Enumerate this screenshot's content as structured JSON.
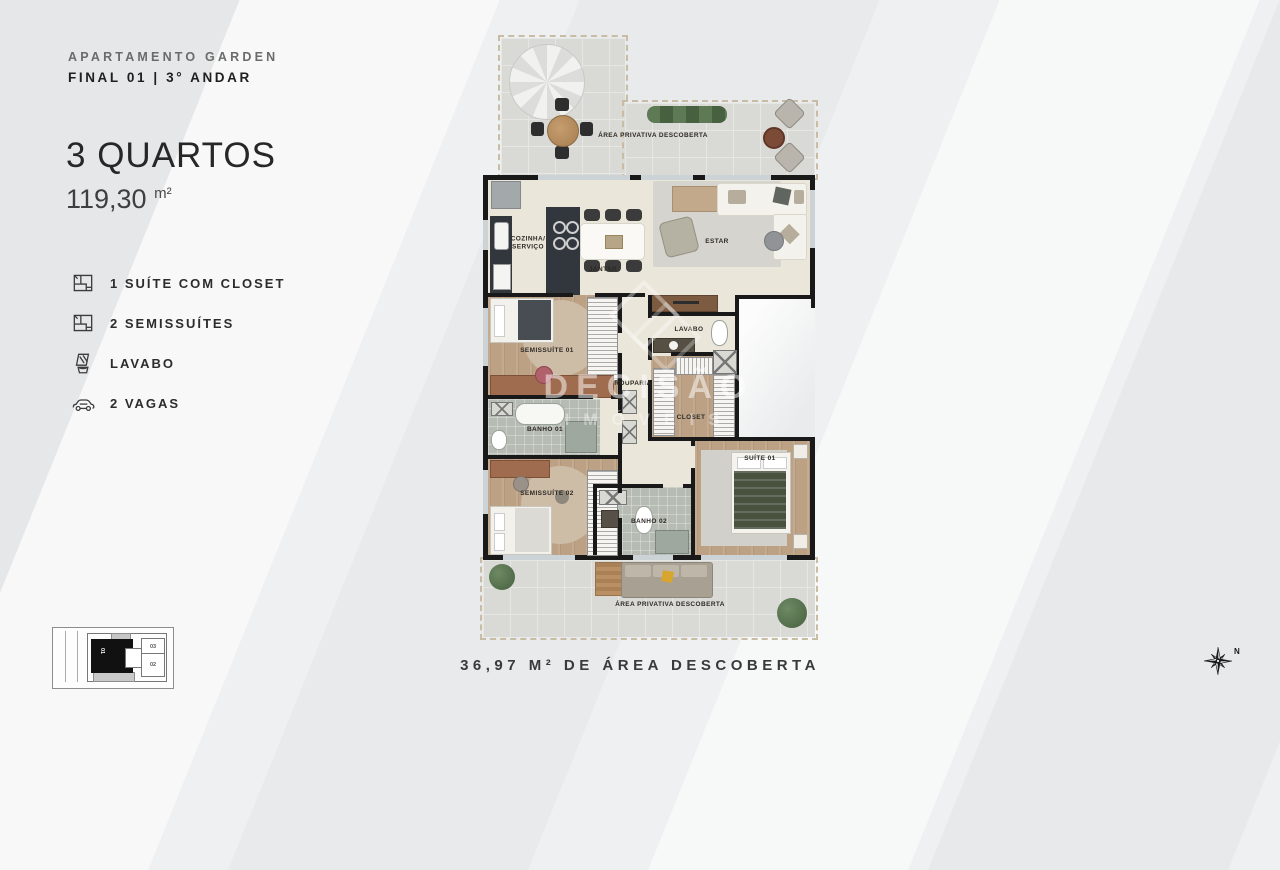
{
  "header": {
    "subtitle": "APARTAMENTO GARDEN",
    "title": "FINAL 01 | 3° ANDAR"
  },
  "unit": {
    "bedrooms": "3 QUARTOS",
    "area": "119,30",
    "area_unit": "m²"
  },
  "features": [
    {
      "icon": "floorplan-icon",
      "label": "1 SUÍTE COM CLOSET"
    },
    {
      "icon": "floorplan-icon",
      "label": "2 SEMISSUÍTES"
    },
    {
      "icon": "washbasin-icon",
      "label": "LAVABO"
    },
    {
      "icon": "car-icon",
      "label": "2 VAGAS"
    }
  ],
  "plan": {
    "rooms": {
      "terrace_top": "ÁREA PRIVATIVA DESCOBERTA",
      "kitchen_line1": "COZINHA/",
      "kitchen_line2": "SERVIÇO",
      "dining": "JANTAR",
      "living": "ESTAR",
      "semisuite1": "SEMISSUÍTE 01",
      "lavabo": "LAVABO",
      "rouparia": "ROUPARIA",
      "closet": "CLOSET",
      "banho1": "BANHO 01",
      "semisuite2": "SEMISSUÍTE 02",
      "banho2": "BANHO 02",
      "suite1": "SUÍTE 01",
      "terrace_bottom": "ÁREA PRIVATIVA DESCOBERTA"
    },
    "watermark": {
      "line1": "DECISÃO",
      "line2": "IMÓVEIS"
    }
  },
  "caption": "36,97 M² DE ÁREA DESCOBERTA",
  "keyplan": {
    "unit_main": "01",
    "unit_03": "03",
    "unit_02": "02"
  },
  "compass": {
    "north_label": "N"
  },
  "colors": {
    "wall": "#191919",
    "floor_interior": "#ebe6da",
    "floor_wood": "#bca185",
    "floor_tile": "#d9d9d5",
    "floor_bath": "#b6bcb3",
    "counter_dark": "#31373c",
    "hedge_green": "#5d7a55",
    "pillow_yellow": "#d8a62e",
    "text_dark": "#262626",
    "text_gray": "#6b6b6b"
  }
}
